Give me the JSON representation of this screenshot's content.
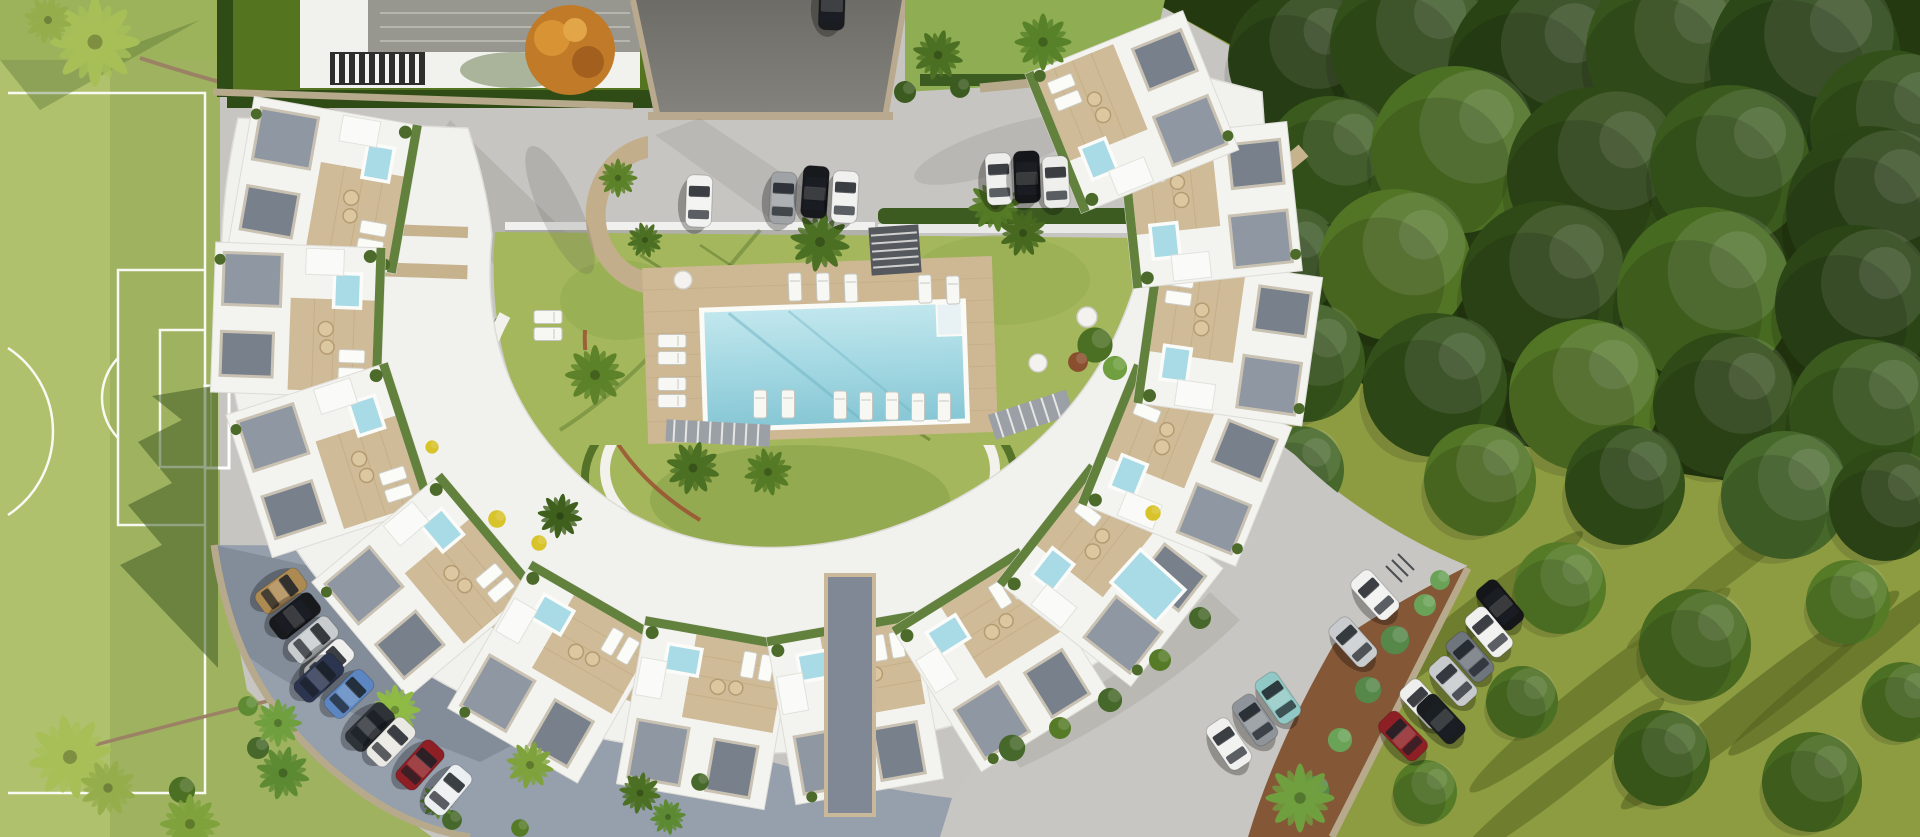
{
  "meta": {
    "description": "Aerial bird's-eye 3D architectural rendering of a crescent-shaped white residential complex with rooftop terraces, central swimming pool, gardens, parking areas, a soccer field on the left and dense woodland on the right. No visible text anywhere in the image.",
    "visible_text": "none"
  },
  "palette": {
    "pavement": "#c7c5c1",
    "asphalt": "#7b7974",
    "shaded_road": "#96a0ad",
    "field_green": "#9fb260",
    "field_green_light": "#b4c672",
    "lawn_green": "#a4b75c",
    "villa_lawn": "#55741f",
    "hedge_green": "#3c5b20",
    "forest_dark": "#24390f",
    "meadow_olive": "#8d9b41",
    "building_white": "#f2f2ef",
    "deck_beige": "#cdb893",
    "wall_beige": "#b7a98b",
    "gravel_gray": "#8f97a3",
    "pool_blue": "#9ed3df",
    "jacuzzi_blue": "#a8dbe6",
    "soil_brown": "#7c4a28",
    "car_red": "#8e1f24",
    "car_teal": "#8fc8c4",
    "car_tan": "#ad8a52"
  },
  "scene": {
    "regions": {
      "field": "soccer field with white markings and goal",
      "villa": "neighbouring villa with gray roof and pergola",
      "driveway": "dark asphalt entrance driveway",
      "top_parking": "upper parking lot with seven parked cars",
      "pool": "community swimming pool with wooden deck and sun loungers",
      "courtyard": "central landscaped courtyard lawn with palm trees",
      "crescent": "crescent of white apartment buildings with rooftop terraces, jacuzzis and pergolas",
      "left_road": "curved shaded road with ten parked cars",
      "right_parking": "lower-right parking lot with parked cars",
      "forest": "dense woodland and olive meadow with long tree shadows"
    }
  },
  "stamps": [
    {
      "name": "forest-tree",
      "template": "#tpl-tree",
      "target": "#layer-forest-trees",
      "items": [
        [
          1300,
          60,
          0,
          "#2c4517",
          1.8
        ],
        [
          1410,
          45,
          0,
          "#33501a",
          2.0
        ],
        [
          1540,
          70,
          0,
          "#2a4315",
          2.3
        ],
        [
          1670,
          50,
          0,
          "#36541c",
          2.1
        ],
        [
          1805,
          60,
          0,
          "#2c4718",
          2.4
        ],
        [
          1890,
          130,
          0,
          "#33501a",
          2.0
        ],
        [
          1330,
          160,
          0,
          "#3a5a1e",
          1.6
        ],
        [
          1455,
          150,
          0,
          "#4c7023",
          2.1
        ],
        [
          1595,
          175,
          0,
          "#2f4a17",
          2.2
        ],
        [
          1730,
          165,
          0,
          "#3a5a1e",
          2.0
        ],
        [
          1870,
          210,
          0,
          "#2c4517",
          2.1
        ],
        [
          1285,
          262,
          0,
          "#33501a",
          1.4
        ],
        [
          1395,
          265,
          0,
          "#527425",
          1.9
        ],
        [
          1545,
          285,
          0,
          "#2f4a17",
          2.1
        ],
        [
          1705,
          295,
          0,
          "#476a21",
          2.2
        ],
        [
          1855,
          305,
          0,
          "#2c4517",
          2.0
        ],
        [
          1305,
          362,
          0,
          "#3a5a1e",
          1.5
        ],
        [
          1435,
          385,
          0,
          "#33501a",
          1.8
        ],
        [
          1585,
          395,
          0,
          "#527425",
          1.9
        ],
        [
          1725,
          405,
          0,
          "#2f4a17",
          1.8
        ],
        [
          1865,
          415,
          0,
          "#3a5a1e",
          1.9
        ],
        [
          1300,
          470,
          0,
          "#46682a",
          1.1
        ],
        [
          1480,
          480,
          0,
          "#527425",
          1.4
        ],
        [
          1625,
          485,
          0,
          "#33501a",
          1.5
        ],
        [
          1785,
          495,
          0,
          "#46682a",
          1.6
        ],
        [
          1885,
          505,
          0,
          "#2f4a17",
          1.4
        ]
      ]
    },
    {
      "name": "meadow-tree",
      "template": "#tpl-tree",
      "target": "#layer-meadow-trees",
      "items": [
        [
          1560,
          588,
          0,
          "#557b27",
          1.15
        ],
        [
          1695,
          645,
          0,
          "#47691f",
          1.4
        ],
        [
          1848,
          602,
          0,
          "#557b27",
          1.05
        ],
        [
          1522,
          702,
          0,
          "#4c7023",
          0.9
        ],
        [
          1662,
          758,
          0,
          "#3f601d",
          1.2
        ],
        [
          1812,
          782,
          0,
          "#47691f",
          1.25
        ],
        [
          1425,
          792,
          0,
          "#557b27",
          0.8
        ],
        [
          1902,
          702,
          0,
          "#4c7023",
          1.0
        ]
      ]
    },
    {
      "name": "tree-shadow",
      "template": "#tpl-streak",
      "target": "#layer-meadow-shadows",
      "items": [
        [
          1470,
          620,
          -38,
          "#57661f",
          1.3,
          1.0
        ],
        [
          1600,
          690,
          -38,
          "#57661f",
          1.5,
          1.1
        ],
        [
          1760,
          700,
          -38,
          "#525f1d",
          1.6,
          1.2
        ],
        [
          1560,
          780,
          -38,
          "#57661f",
          1.2,
          0.9
        ],
        [
          1740,
          560,
          -38,
          "#5c6b22",
          1.3,
          0.8
        ],
        [
          1850,
          660,
          -38,
          "#525f1d",
          1.4,
          1.0
        ]
      ]
    },
    {
      "name": "palm-tree",
      "template": "#tpl-palm",
      "target": "#layer-palms",
      "items": [
        [
          95,
          42,
          0,
          "#a8bf58",
          1.5
        ],
        [
          48,
          20,
          12,
          "#96ad4c",
          0.8
        ],
        [
          820,
          242,
          10,
          "#4c7023",
          1.0
        ],
        [
          995,
          205,
          -8,
          "#557b27",
          0.9
        ],
        [
          1023,
          233,
          20,
          "#47691f",
          0.8
        ],
        [
          595,
          375,
          0,
          "#5d8229",
          1.0
        ],
        [
          693,
          468,
          15,
          "#4c7023",
          0.9
        ],
        [
          768,
          472,
          -12,
          "#557b27",
          0.8
        ],
        [
          560,
          516,
          8,
          "#3f601d",
          0.75
        ],
        [
          618,
          178,
          0,
          "#5d8229",
          0.65
        ],
        [
          645,
          240,
          30,
          "#4c7023",
          0.6
        ],
        [
          1043,
          42,
          0,
          "#57822a",
          0.95
        ],
        [
          938,
          55,
          14,
          "#4c7023",
          0.85
        ],
        [
          70,
          757,
          -10,
          "#a8bf58",
          1.4
        ],
        [
          108,
          788,
          18,
          "#96ad4c",
          0.95
        ],
        [
          190,
          824,
          0,
          "#7fa23c",
          1.0
        ],
        [
          395,
          710,
          0,
          "#8fbb45",
          0.85
        ],
        [
          530,
          765,
          12,
          "#7fa23c",
          0.8
        ],
        [
          278,
          723,
          0,
          "#6f9f3e",
          0.8
        ],
        [
          283,
          773,
          14,
          "#5d8a33",
          0.9
        ],
        [
          1300,
          798,
          0,
          "#6f9f3e",
          1.15
        ],
        [
          438,
          801,
          0,
          "#5d8a33",
          0.6
        ],
        [
          640,
          793,
          10,
          "#4c7023",
          0.7
        ],
        [
          668,
          817,
          -8,
          "#5d8a33",
          0.6
        ]
      ]
    },
    {
      "name": "shrub",
      "template": "#tpl-shrub",
      "target": "#layer-shrubs",
      "items": [
        [
          1095,
          345,
          0,
          "#4c7023",
          1.6
        ],
        [
          1115,
          368,
          0,
          "#6f9f3e",
          1.1
        ],
        [
          1078,
          362,
          0,
          "#8a4f2e",
          0.9
        ],
        [
          182,
          790,
          0,
          "#4c7023",
          1.2
        ],
        [
          905,
          92,
          0,
          "#3c5b20",
          1.0
        ],
        [
          960,
          88,
          0,
          "#3c5b20",
          0.9
        ],
        [
          1012,
          748,
          0,
          "#46682a",
          1.2
        ],
        [
          1060,
          728,
          0,
          "#557b27",
          1.0
        ],
        [
          1110,
          700,
          0,
          "#46682a",
          1.1
        ],
        [
          1160,
          660,
          0,
          "#557b27",
          1.0
        ],
        [
          1200,
          618,
          0,
          "#46682a",
          1.0
        ],
        [
          1395,
          640,
          0,
          "#56884a",
          1.3
        ],
        [
          1425,
          605,
          0,
          "#6aa257",
          1.0
        ],
        [
          1368,
          690,
          0,
          "#56884a",
          1.2
        ],
        [
          1340,
          740,
          0,
          "#6aa257",
          1.1
        ],
        [
          1315,
          790,
          0,
          "#56884a",
          1.3
        ],
        [
          1440,
          580,
          0,
          "#6aa257",
          0.9
        ],
        [
          248,
          706,
          0,
          "#5d8a33",
          0.9
        ],
        [
          258,
          748,
          0,
          "#46682a",
          1.0
        ],
        [
          497,
          519,
          0,
          "#d8c32a",
          0.8
        ],
        [
          539,
          543,
          0,
          "#d8c32a",
          0.7
        ],
        [
          1153,
          513,
          0,
          "#d8c32a",
          0.7
        ],
        [
          432,
          447,
          0,
          "#d8c32a",
          0.6
        ],
        [
          452,
          820,
          0,
          "#46682a",
          0.9
        ],
        [
          520,
          828,
          0,
          "#557b27",
          0.8
        ],
        [
          700,
          782,
          0,
          "#46682a",
          0.8
        ]
      ]
    },
    {
      "name": "sun-lounger",
      "template": "#tpl-lounger",
      "target": "#layer-loungers",
      "items": [
        [
          795,
          287,
          -2
        ],
        [
          823,
          287,
          -2
        ],
        [
          851,
          288,
          -2
        ],
        [
          925,
          289,
          -2
        ],
        [
          953,
          290,
          -2
        ],
        [
          760,
          404,
          0
        ],
        [
          788,
          404,
          0
        ],
        [
          840,
          405,
          0
        ],
        [
          866,
          406,
          0
        ],
        [
          892,
          406,
          0
        ],
        [
          918,
          407,
          0
        ],
        [
          944,
          407,
          0
        ],
        [
          672,
          341,
          90
        ],
        [
          672,
          358,
          90
        ],
        [
          672,
          384,
          90
        ],
        [
          672,
          401,
          90
        ],
        [
          548,
          317,
          90
        ],
        [
          548,
          334,
          90
        ]
      ]
    },
    {
      "name": "round-table",
      "template": "#tpl-disc",
      "target": "#layer-discs",
      "items": [
        [
          683,
          280,
          0,
          "",
          0.9
        ],
        [
          1087,
          317,
          0,
          "",
          1.0
        ],
        [
          1038,
          363,
          0,
          "",
          0.9
        ]
      ]
    },
    {
      "name": "walkway-spoke",
      "template": "#tpl-spoke",
      "target": "#layer-spokes",
      "items": [
        [
          345,
          268,
          2,
          "",
          1.75,
          1.0
        ],
        [
          398,
          230,
          2,
          "",
          1.0,
          0.8
        ],
        [
          1266,
          182,
          -40,
          "",
          0.7,
          1.1
        ],
        [
          620,
          690,
          24,
          "",
          0.9,
          0.9
        ],
        [
          480,
          610,
          40,
          "",
          0.8,
          0.8
        ],
        [
          1120,
          600,
          -45,
          "",
          0.8,
          0.9
        ]
      ]
    },
    {
      "name": "apartment-unit",
      "template": "#tpl-unit",
      "target": "#layer-units",
      "items": [
        [
          325,
          185,
          100
        ],
        [
          298,
          320,
          92
        ],
        [
          330,
          460,
          72
        ],
        [
          425,
          585,
          50
        ],
        [
          555,
          672,
          30
        ],
        [
          705,
          713,
          10
        ],
        [
          855,
          708,
          -10
        ],
        [
          1000,
          660,
          -32
        ],
        [
          1110,
          575,
          -52
        ],
        [
          1185,
          465,
          -68
        ],
        [
          1228,
          340,
          -82
        ],
        [
          1210,
          205,
          -96
        ],
        [
          1132,
          112,
          -112
        ]
      ]
    },
    {
      "name": "car",
      "template": "#tpl-car",
      "target": "#layer-cars",
      "items": [
        [
          699,
          201,
          2,
          "#f2f2f0"
        ],
        [
          783,
          198,
          3,
          "#9fa3a6"
        ],
        [
          815,
          192,
          4,
          "#17191c"
        ],
        [
          845,
          197,
          3,
          "#f0f0ee"
        ],
        [
          999,
          179,
          -3,
          "#eeeeec"
        ],
        [
          1027,
          177,
          -2,
          "#141619"
        ],
        [
          1056,
          182,
          -3,
          "#ececea"
        ],
        [
          832,
          4,
          2,
          "#1a1c1f"
        ],
        [
          281,
          591,
          54,
          "#ad8a52"
        ],
        [
          295,
          616,
          52,
          "#17191c"
        ],
        [
          313,
          640,
          50,
          "#c8ccce"
        ],
        [
          329,
          663,
          48,
          "#efefed"
        ],
        [
          319,
          678,
          47,
          "#2b3550"
        ],
        [
          349,
          694,
          46,
          "#5b86c2"
        ],
        [
          370,
          727,
          45,
          "#2e3338"
        ],
        [
          391,
          742,
          44,
          "#e9e8e2"
        ],
        [
          420,
          765,
          42,
          "#8e1f24"
        ],
        [
          448,
          790,
          40,
          "#eceff1"
        ],
        [
          1278,
          698,
          -35,
          "#8fc8c4"
        ],
        [
          1255,
          720,
          -35,
          "#8e9499"
        ],
        [
          1229,
          744,
          -34,
          "#f0f0ee"
        ],
        [
          1375,
          595,
          -42,
          "#f1f1ef"
        ],
        [
          1353,
          642,
          -42,
          "#c9ccce"
        ],
        [
          1500,
          605,
          -40,
          "#141619"
        ],
        [
          1489,
          632,
          -40,
          "#f0f0ee"
        ],
        [
          1470,
          657,
          -41,
          "#6f757c"
        ],
        [
          1453,
          681,
          -42,
          "#c6cacc"
        ],
        [
          1424,
          704,
          -43,
          "#eeeeec"
        ],
        [
          1441,
          719,
          -43,
          "#1a1d20"
        ],
        [
          1403,
          736,
          -44,
          "#8e1f24"
        ]
      ]
    }
  ]
}
